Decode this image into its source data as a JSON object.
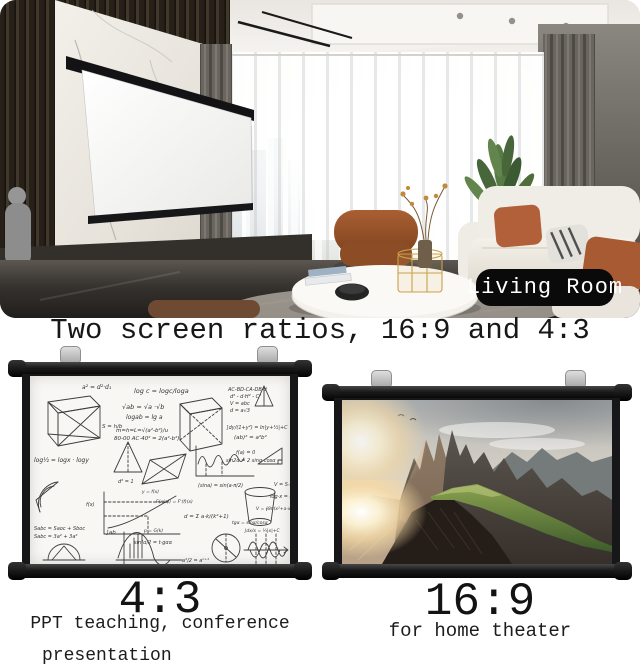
{
  "hero": {
    "badge_label": "Living Room"
  },
  "headline": "Two screen ratios, 16:9 and 4:3",
  "left_screen": {
    "ratio": "4:3",
    "caption_line1": "PPT teaching, conference",
    "caption_line2": "presentation",
    "formulas": [
      "a² = d²·d₁",
      "log c = logc/loga",
      "√ab = √a ·√b",
      "logab = lg a",
      "S = h/b",
      "m=h=L=√(a²-b²)/u",
      "80-00  AC·40² = 2(a²-b²)",
      "AC-BD-CA-DB-d",
      "d² - d·H² - C²",
      "V = abc",
      "d = a√3",
      "∫dy/(1+y²) = ln|y+½|+C",
      "(ab)² = a²b²",
      "log½ = logx · logy",
      "d² = 1",
      "f(a) = 0",
      "sin2α = 2 sinα·cosα",
      "(sina) = sin(a·π/2)",
      "f(x)",
      "y = f(x)",
      "F(x(a)) = F'(f)(x)",
      "d = Σ a·k/(k²+1)",
      "V = S·h",
      "log·x = u",
      "V = ∮8π(x²+a·x⁴)",
      "tgα = sinα/cosα",
      "∫dx/x = ⅓|x|+C",
      "Sabc = Saoc + Sboc",
      "Sabc = 3a² + 3a²",
      "∫ab",
      "p = G(k)",
      "sin²α/2 = t·gαα",
      "a²/2 = aⁿ⁺¹"
    ]
  },
  "right_screen": {
    "ratio": "16:9",
    "caption_line1": "for home theater"
  },
  "colors": {
    "background": "#ffffff",
    "text": "#171717",
    "badge_bg": "#0a0a0a",
    "badge_text": "#ffffff",
    "frame_black": "#17171a",
    "screen_white": "#f8f7f4",
    "ridge_green": "#5d7d3a",
    "sunset_glow": "#f5d9a4"
  }
}
